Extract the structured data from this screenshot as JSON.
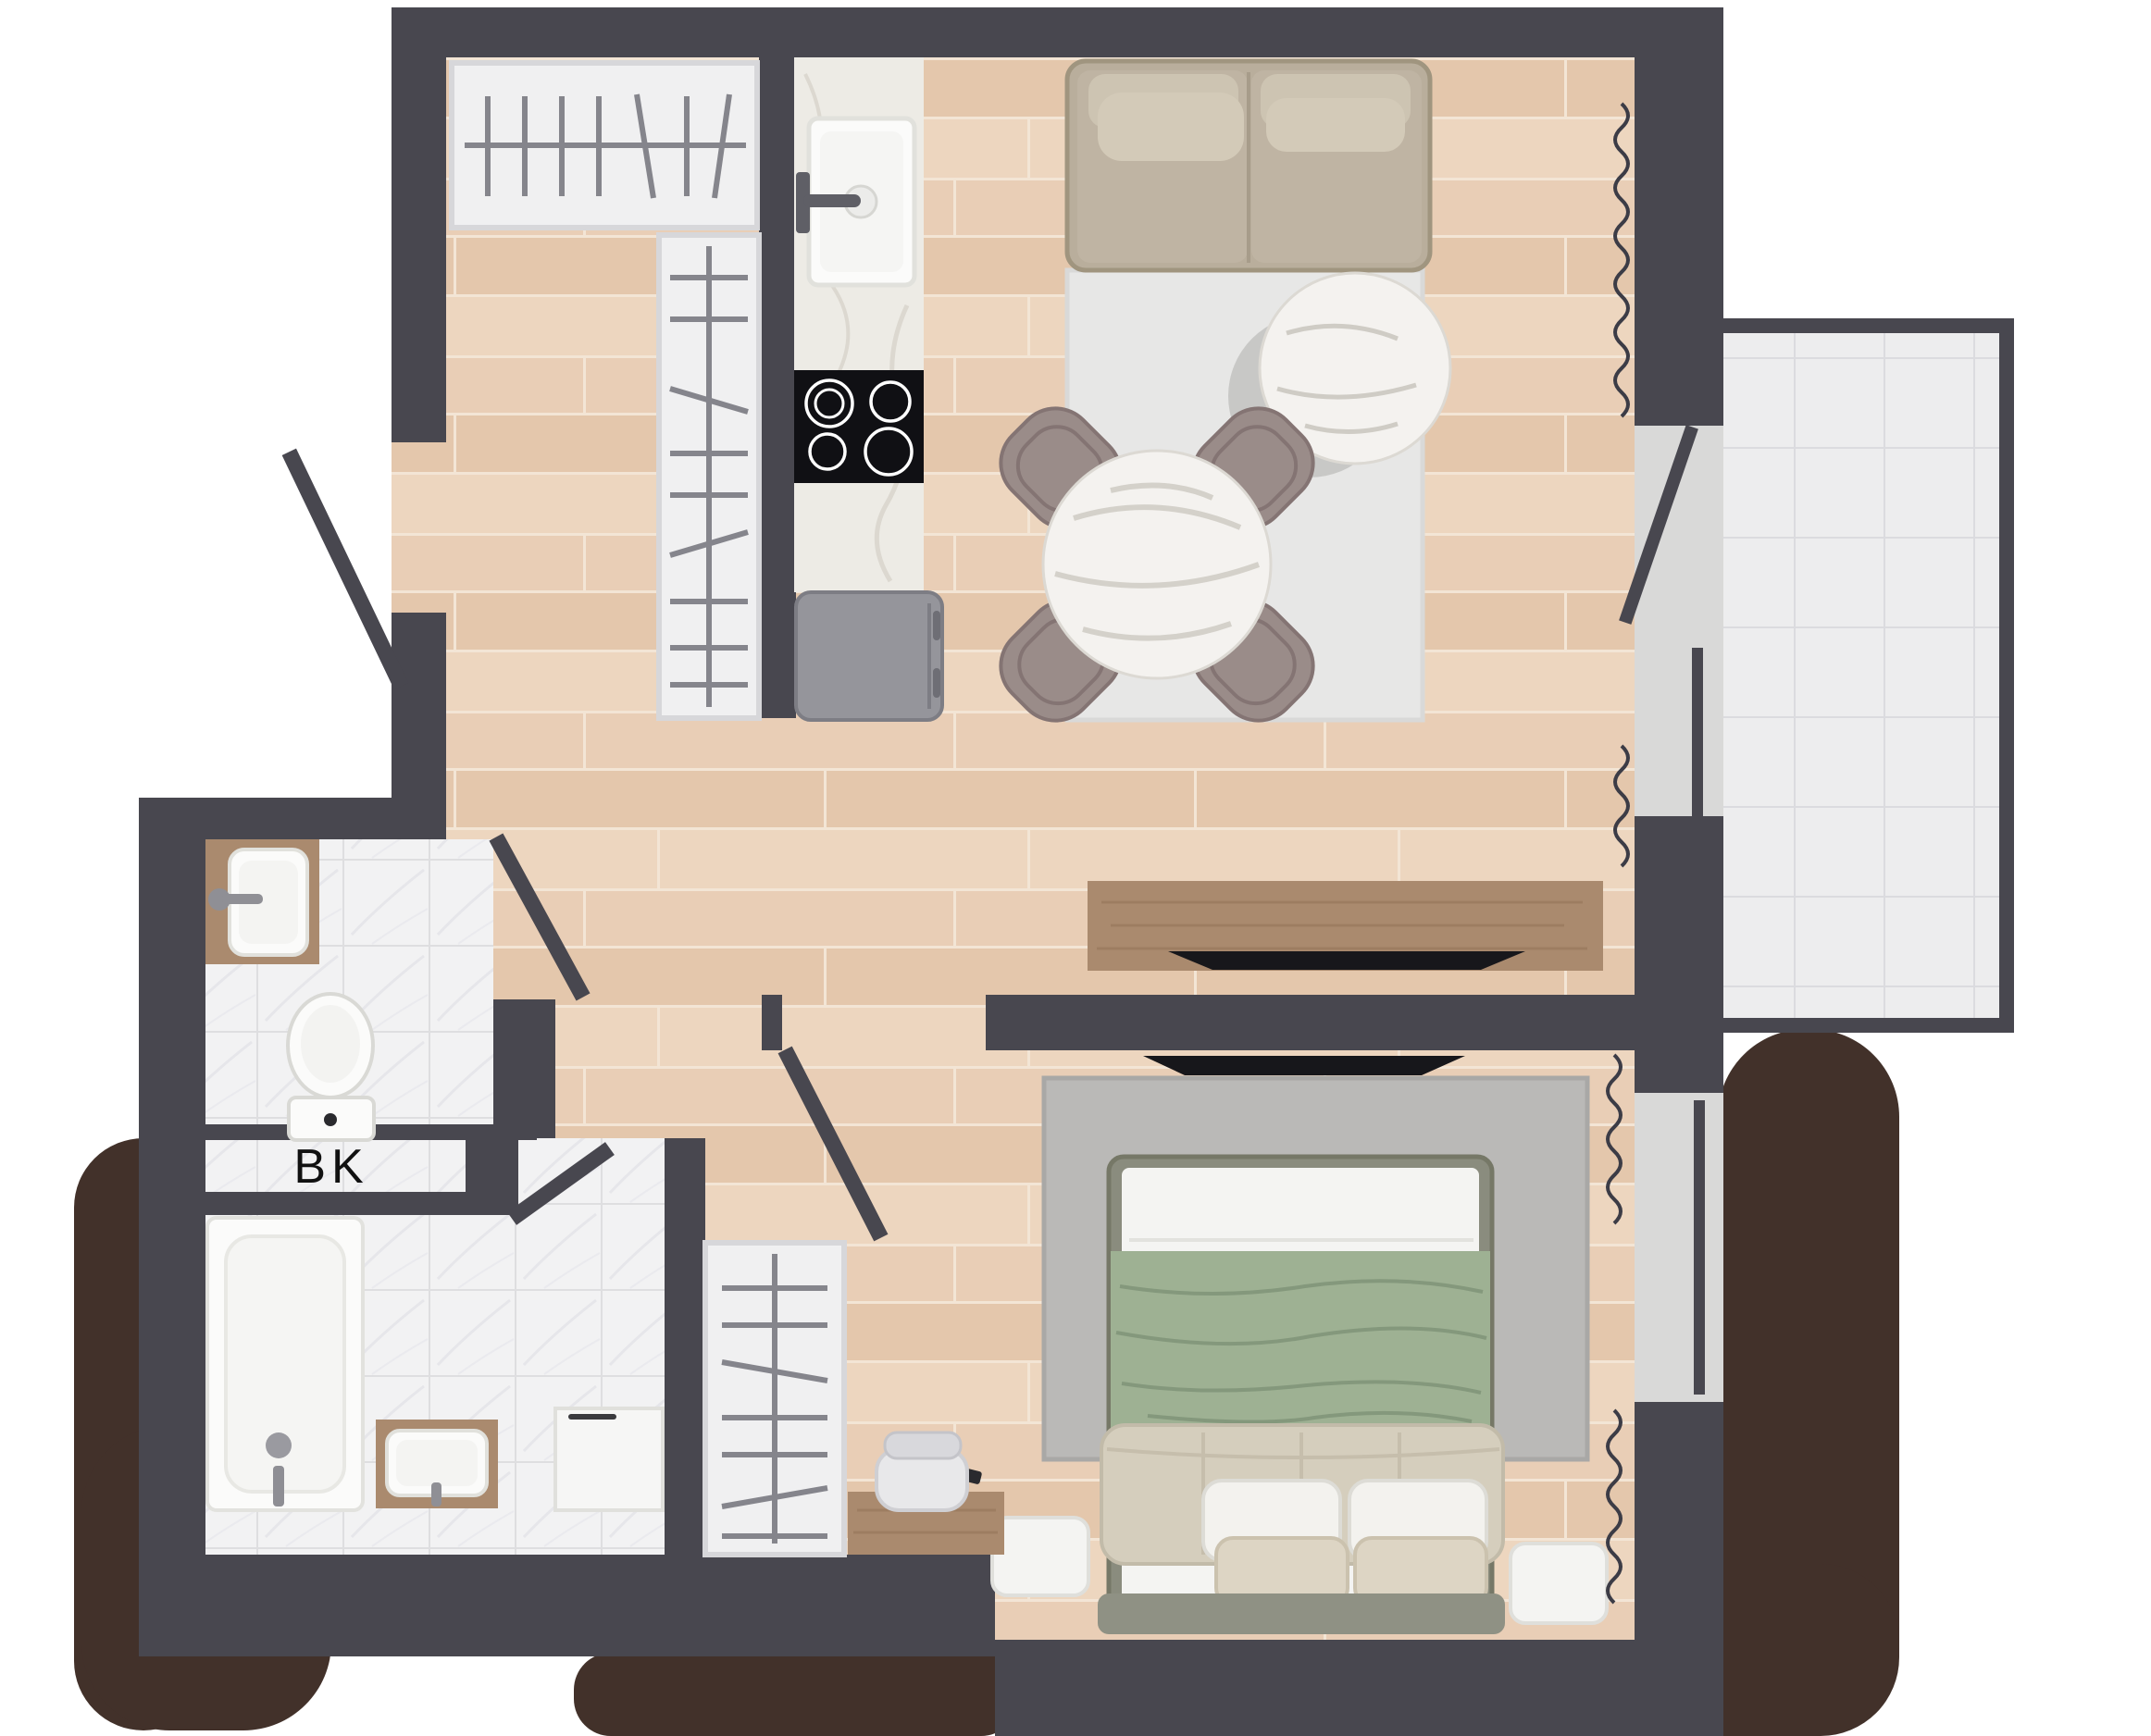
{
  "title": "apartment-floor-plan",
  "label": {
    "storage_closet": "BK"
  },
  "colors": {
    "wall": "#48474f",
    "shadow": "#42312a",
    "wood_floor": "#e8cdb5",
    "plank_seam": "#f4e6d6",
    "tile_floor": "#f2f2f3",
    "tile_grout": "#dedee0",
    "balcony_tile": "#ededee",
    "balcony_grout": "#dbdbdf",
    "counter_marble": "#edebe5",
    "sofa": "#b9ae9c",
    "sofa_cushion": "#cdc4b2",
    "rug_living": "#e7e7e6",
    "rug_bedroom": "#bab9b7",
    "table_marble": "#f4f2ef",
    "chair": "#9a8c89",
    "wood_furniture": "#aa8a6e",
    "appliance_gray": "#95959b",
    "cooktop": "#101014",
    "tv": "#17171b",
    "bed_frame": "#8a8c7e",
    "blanket_sage": "#9eb193",
    "duvet_beige": "#d5cebd",
    "pillow_white": "#f3f2ee",
    "pillow_beige": "#ddd5c4",
    "fixture_white": "#fbfbfa",
    "curtain": "#3c3c46",
    "threshold": "#d9d9d8",
    "label_text": "#111111"
  }
}
